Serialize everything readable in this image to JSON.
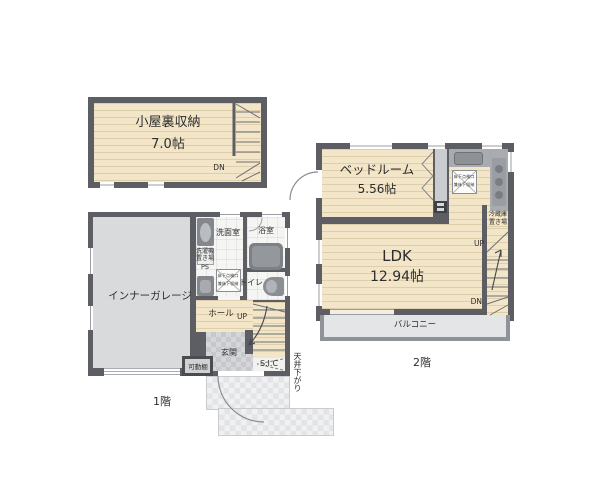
{
  "attic": {
    "name": "小屋裏収納",
    "size": "7.0帖",
    "dn": "DN"
  },
  "f1": {
    "floor": "1階",
    "garage": "インナーガレージ",
    "washroom": "洗面室",
    "bathroom": "浴室",
    "laundry1": "洗濯機",
    "laundry2": "置き場",
    "ps": "PS",
    "toilet": "トイレ",
    "hatch1": "床下点検口",
    "hatch2": "兼床下収納",
    "hall": "ホール",
    "up": "UP",
    "entrance": "玄関",
    "shelf": "可動棚",
    "sic": "S.I.C",
    "ceiling_drop": "天井下がり"
  },
  "f2": {
    "floor": "2階",
    "bedroom": "ベッドルーム",
    "bedroom_size": "5.56帖",
    "ldk": "LDK",
    "ldk_size": "12.94帖",
    "balcony": "バルコニー",
    "fridge1": "冷蔵庫",
    "fridge2": "置き場",
    "up": "UP",
    "dn": "DN",
    "hatch1": "床下点検口",
    "hatch2": "兼床下収納"
  },
  "colors": {
    "wall": "#5c5e63",
    "wood_floor": "#f3e6c8",
    "tile_floor": "#f5f5f3",
    "garage_floor": "#d9dadc",
    "entrance_tile": "#c6c8cb",
    "porch_tile": "#e3e4e6",
    "balcony_floor": "#e4e5e7",
    "counter": "#a8abb0",
    "fixture": "#84878c",
    "text": "#2e2e2e"
  }
}
